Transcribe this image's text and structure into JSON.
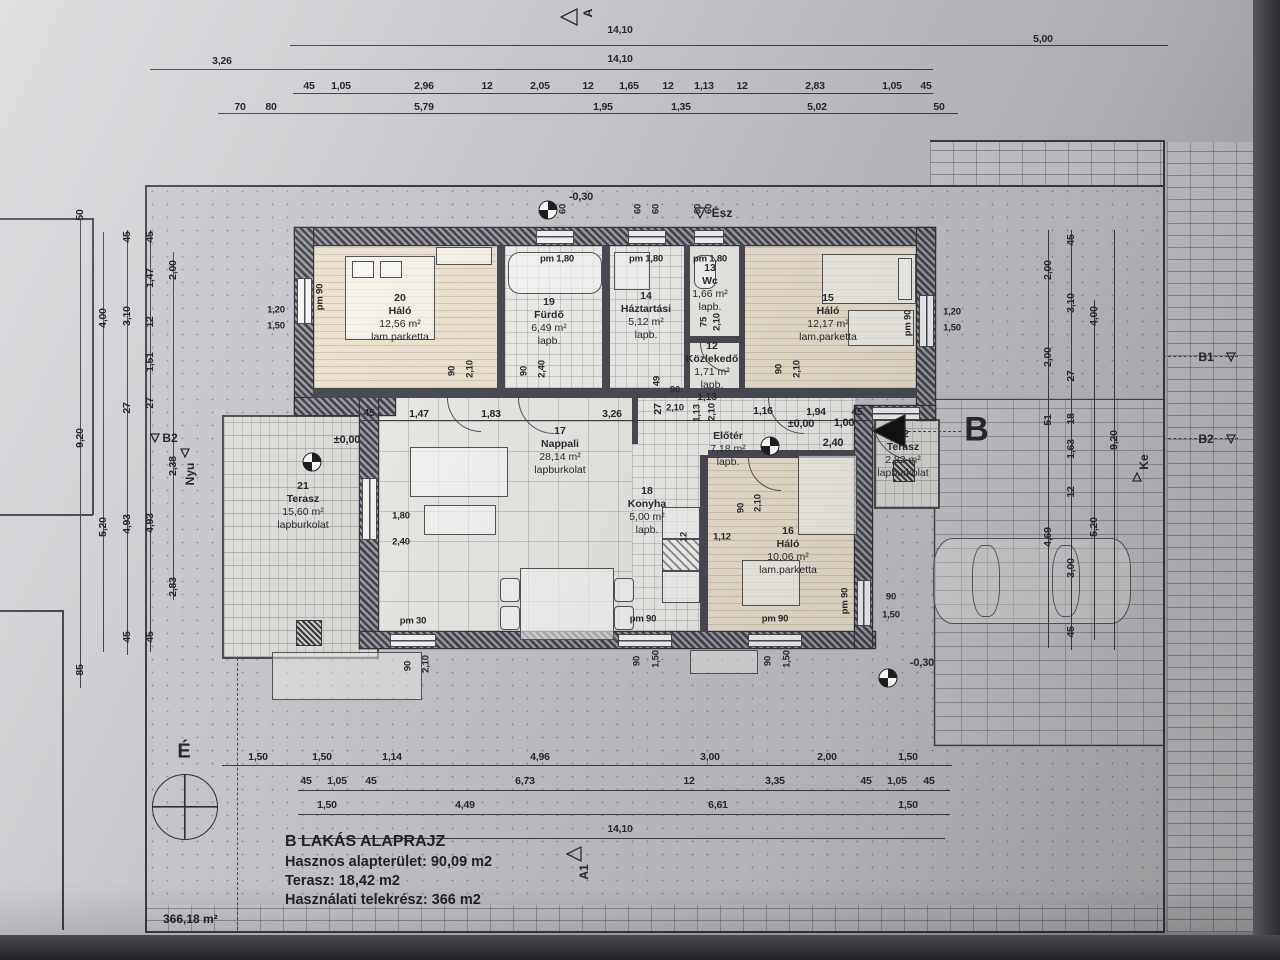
{
  "colors": {
    "paper": "#c9c9cd",
    "ink": "#26262c",
    "wall": "#45454e",
    "accent": "#111111"
  },
  "compass": {
    "label": "É"
  },
  "plot": {
    "area_label": "366,18 m²"
  },
  "title_block": {
    "title": "B LAKÁS ALAPRAJZ",
    "line2": "Hasznos alapterület: 90,09 m2",
    "line3": "Terasz:  18,42 m2",
    "line4": "Használati telekrész: 366 m2"
  },
  "rooms": [
    {
      "num": "20",
      "name": "Háló",
      "area": "12,56 m²",
      "floor": "lam.parketta",
      "x": 400,
      "y": 292,
      "w": 120
    },
    {
      "num": "19",
      "name": "Fürdő",
      "area": "6,49 m²",
      "floor": "lapb.",
      "x": 549,
      "y": 296,
      "w": 70
    },
    {
      "num": "14",
      "name": "Háztartási",
      "area": "5,12 m²",
      "floor": "lapb.",
      "x": 646,
      "y": 290,
      "w": 80
    },
    {
      "num": "13",
      "name": "Wc",
      "area": "1,66 m²",
      "floor": "lapb.",
      "x": 710,
      "y": 262,
      "w": 50
    },
    {
      "num": "15",
      "name": "Háló",
      "area": "12,17 m²",
      "floor": "lam.parketta",
      "x": 828,
      "y": 292,
      "w": 120
    },
    {
      "num": "12",
      "name": "Közlekedő",
      "area": "1,71 m²",
      "floor": "lapb.",
      "x": 712,
      "y": 340,
      "w": 90
    },
    {
      "num": "17",
      "name": "Nappali",
      "area": "28,14 m²",
      "floor": "lapburkolat",
      "x": 560,
      "y": 425,
      "w": 120
    },
    {
      "num": "18",
      "name": "Konyha",
      "area": "5,00 m²",
      "floor": "lapb.",
      "x": 647,
      "y": 485,
      "w": 70
    },
    {
      "num": "",
      "name": "Előtér",
      "area": "7,18 m²",
      "floor": "lapb.",
      "x": 728,
      "y": 430,
      "w": 80
    },
    {
      "num": "16",
      "name": "Háló",
      "area": "10,06 m²",
      "floor": "lam.parketta",
      "x": 788,
      "y": 525,
      "w": 110
    },
    {
      "num": "21",
      "name": "Terasz",
      "area": "15,60 m²",
      "floor": "lapburkolat",
      "x": 303,
      "y": 480,
      "w": 110
    },
    {
      "num": "22",
      "name": "Terasz",
      "area": "2,82 m²",
      "floor": "lapburkolat",
      "x": 903,
      "y": 428,
      "w": 90
    }
  ],
  "dims": [
    {
      "t": "14,10",
      "x": 620,
      "y": 30
    },
    {
      "t": "5,00",
      "x": 1043,
      "y": 39
    },
    {
      "t": "3,26",
      "x": 222,
      "y": 61
    },
    {
      "t": "14,10",
      "x": 620,
      "y": 59
    },
    {
      "t": "45",
      "x": 309,
      "y": 86
    },
    {
      "t": "1,05",
      "x": 341,
      "y": 86
    },
    {
      "t": "2,96",
      "x": 424,
      "y": 86
    },
    {
      "t": "12",
      "x": 487,
      "y": 86
    },
    {
      "t": "2,05",
      "x": 540,
      "y": 86
    },
    {
      "t": "12",
      "x": 588,
      "y": 86
    },
    {
      "t": "1,65",
      "x": 629,
      "y": 86
    },
    {
      "t": "12",
      "x": 668,
      "y": 86
    },
    {
      "t": "1,13",
      "x": 704,
      "y": 86
    },
    {
      "t": "12",
      "x": 742,
      "y": 86
    },
    {
      "t": "2,83",
      "x": 815,
      "y": 86
    },
    {
      "t": "1,05",
      "x": 892,
      "y": 86
    },
    {
      "t": "45",
      "x": 926,
      "y": 86
    },
    {
      "t": "70",
      "x": 240,
      "y": 107
    },
    {
      "t": "80",
      "x": 271,
      "y": 107
    },
    {
      "t": "5,79",
      "x": 424,
      "y": 107
    },
    {
      "t": "1,95",
      "x": 603,
      "y": 107
    },
    {
      "t": "1,35",
      "x": 681,
      "y": 107
    },
    {
      "t": "5,02",
      "x": 817,
      "y": 107
    },
    {
      "t": "50",
      "x": 939,
      "y": 107
    },
    {
      "t": "45",
      "x": 369,
      "y": 413
    },
    {
      "t": "1,47",
      "x": 419,
      "y": 414
    },
    {
      "t": "1,83",
      "x": 491,
      "y": 414
    },
    {
      "t": "3,26",
      "x": 612,
      "y": 414
    },
    {
      "t": "27",
      "x": 658,
      "y": 409,
      "r": 1
    },
    {
      "t": "1,13",
      "x": 707,
      "y": 397
    },
    {
      "t": "1,16",
      "x": 763,
      "y": 411
    },
    {
      "t": "1,94",
      "x": 816,
      "y": 412
    },
    {
      "t": "45",
      "x": 857,
      "y": 412
    },
    {
      "t": "1,50",
      "x": 258,
      "y": 757
    },
    {
      "t": "1,50",
      "x": 322,
      "y": 757
    },
    {
      "t": "1,14",
      "x": 392,
      "y": 757
    },
    {
      "t": "4,96",
      "x": 540,
      "y": 757
    },
    {
      "t": "3,00",
      "x": 710,
      "y": 757
    },
    {
      "t": "2,00",
      "x": 827,
      "y": 757
    },
    {
      "t": "1,50",
      "x": 908,
      "y": 757
    },
    {
      "t": "45",
      "x": 306,
      "y": 781
    },
    {
      "t": "1,05",
      "x": 337,
      "y": 781
    },
    {
      "t": "45",
      "x": 371,
      "y": 781
    },
    {
      "t": "6,73",
      "x": 525,
      "y": 781
    },
    {
      "t": "12",
      "x": 689,
      "y": 781
    },
    {
      "t": "3,35",
      "x": 775,
      "y": 781
    },
    {
      "t": "45",
      "x": 866,
      "y": 781
    },
    {
      "t": "1,05",
      "x": 897,
      "y": 781
    },
    {
      "t": "45",
      "x": 929,
      "y": 781
    },
    {
      "t": "1,50",
      "x": 327,
      "y": 805
    },
    {
      "t": "4,49",
      "x": 465,
      "y": 805
    },
    {
      "t": "6,61",
      "x": 718,
      "y": 805
    },
    {
      "t": "1,50",
      "x": 908,
      "y": 805
    },
    {
      "t": "14,10",
      "x": 620,
      "y": 829
    },
    {
      "t": "50",
      "x": 80,
      "y": 215,
      "r": 1
    },
    {
      "t": "9,20",
      "x": 80,
      "y": 438,
      "r": 1
    },
    {
      "t": "85",
      "x": 80,
      "y": 670,
      "r": 1
    },
    {
      "t": "4,00",
      "x": 103,
      "y": 318,
      "r": 1
    },
    {
      "t": "5,20",
      "x": 103,
      "y": 527,
      "r": 1
    },
    {
      "t": "45",
      "x": 127,
      "y": 237,
      "r": 1
    },
    {
      "t": "3,10",
      "x": 127,
      "y": 316,
      "r": 1
    },
    {
      "t": "27",
      "x": 127,
      "y": 408,
      "r": 1
    },
    {
      "t": "4,93",
      "x": 127,
      "y": 524,
      "r": 1
    },
    {
      "t": "45",
      "x": 127,
      "y": 637,
      "r": 1
    },
    {
      "t": "45",
      "x": 150,
      "y": 237,
      "r": 1
    },
    {
      "t": "1,47",
      "x": 150,
      "y": 278,
      "r": 1
    },
    {
      "t": "12",
      "x": 150,
      "y": 322,
      "r": 1
    },
    {
      "t": "1,51",
      "x": 150,
      "y": 362,
      "r": 1
    },
    {
      "t": "27",
      "x": 150,
      "y": 403,
      "r": 1
    },
    {
      "t": "4,93",
      "x": 150,
      "y": 523,
      "r": 1
    },
    {
      "t": "45",
      "x": 150,
      "y": 637,
      "r": 1
    },
    {
      "t": "2,00",
      "x": 173,
      "y": 270,
      "r": 1
    },
    {
      "t": "2,38",
      "x": 173,
      "y": 466,
      "r": 1
    },
    {
      "t": "2,83",
      "x": 173,
      "y": 587,
      "r": 1
    },
    {
      "t": "2,00",
      "x": 1048,
      "y": 270,
      "r": 1
    },
    {
      "t": "2,00",
      "x": 1048,
      "y": 357,
      "r": 1
    },
    {
      "t": "51",
      "x": 1048,
      "y": 420,
      "r": 1
    },
    {
      "t": "4,69",
      "x": 1048,
      "y": 537,
      "r": 1
    },
    {
      "t": "45",
      "x": 1071,
      "y": 240,
      "r": 1
    },
    {
      "t": "3,10",
      "x": 1071,
      "y": 303,
      "r": 1
    },
    {
      "t": "27",
      "x": 1071,
      "y": 376,
      "r": 1
    },
    {
      "t": "18",
      "x": 1071,
      "y": 419,
      "r": 1
    },
    {
      "t": "1,63",
      "x": 1071,
      "y": 449,
      "r": 1
    },
    {
      "t": "12",
      "x": 1071,
      "y": 492,
      "r": 1
    },
    {
      "t": "3,00",
      "x": 1071,
      "y": 568,
      "r": 1
    },
    {
      "t": "45",
      "x": 1071,
      "y": 632,
      "r": 1
    },
    {
      "t": "4,00",
      "x": 1094,
      "y": 316,
      "r": 1
    },
    {
      "t": "5,20",
      "x": 1094,
      "y": 527,
      "r": 1
    },
    {
      "t": "9,20",
      "x": 1114,
      "y": 440,
      "r": 1
    }
  ],
  "fixtures": [
    {
      "t": "pm 1,80",
      "x": 557,
      "y": 259
    },
    {
      "t": "pm 1,80",
      "x": 646,
      "y": 259
    },
    {
      "t": "pm 1,80",
      "x": 710,
      "y": 259
    },
    {
      "t": "pm 90",
      "x": 320,
      "y": 297,
      "r": 1
    },
    {
      "t": "pm 90",
      "x": 908,
      "y": 323,
      "r": 1
    },
    {
      "t": "pm 90",
      "x": 845,
      "y": 601,
      "r": 1
    },
    {
      "t": "1,20",
      "x": 276,
      "y": 310
    },
    {
      "t": "1,50",
      "x": 276,
      "y": 326
    },
    {
      "t": "1,20",
      "x": 952,
      "y": 312
    },
    {
      "t": "1,50",
      "x": 952,
      "y": 328
    },
    {
      "t": "90",
      "x": 891,
      "y": 597
    },
    {
      "t": "1,50",
      "x": 891,
      "y": 615
    },
    {
      "t": "pm 30",
      "x": 413,
      "y": 621
    },
    {
      "t": "pm 90",
      "x": 643,
      "y": 619
    },
    {
      "t": "pm 90",
      "x": 775,
      "y": 619
    },
    {
      "t": "90",
      "x": 637,
      "y": 661,
      "r": 1
    },
    {
      "t": "1,50",
      "x": 656,
      "y": 659,
      "r": 1
    },
    {
      "t": "90",
      "x": 768,
      "y": 661,
      "r": 1
    },
    {
      "t": "1,50",
      "x": 787,
      "y": 659,
      "r": 1
    },
    {
      "t": "90",
      "x": 408,
      "y": 666,
      "r": 1
    },
    {
      "t": "2,10",
      "x": 426,
      "y": 664,
      "r": 1
    },
    {
      "t": "90",
      "x": 452,
      "y": 371,
      "r": 1
    },
    {
      "t": "2,10",
      "x": 470,
      "y": 369,
      "r": 1
    },
    {
      "t": "90",
      "x": 524,
      "y": 371,
      "r": 1
    },
    {
      "t": "2,40",
      "x": 542,
      "y": 369,
      "r": 1
    },
    {
      "t": "90",
      "x": 779,
      "y": 369,
      "r": 1
    },
    {
      "t": "2,10",
      "x": 797,
      "y": 369,
      "r": 1
    },
    {
      "t": "90",
      "x": 741,
      "y": 508,
      "r": 1
    },
    {
      "t": "2,10",
      "x": 758,
      "y": 503,
      "r": 1
    },
    {
      "t": "75",
      "x": 704,
      "y": 322,
      "r": 1
    },
    {
      "t": "2,10",
      "x": 717,
      "y": 322,
      "r": 1
    },
    {
      "t": "1,13",
      "x": 697,
      "y": 413,
      "r": 1
    },
    {
      "t": "2,10",
      "x": 712,
      "y": 412,
      "r": 1
    },
    {
      "t": "49",
      "x": 657,
      "y": 381,
      "r": 1
    },
    {
      "t": "12",
      "x": 684,
      "y": 537,
      "r": 1
    },
    {
      "t": "60",
      "x": 563,
      "y": 209,
      "r": 1
    },
    {
      "t": "60",
      "x": 638,
      "y": 209,
      "r": 1
    },
    {
      "t": "60",
      "x": 656,
      "y": 209,
      "r": 1
    },
    {
      "t": "60",
      "x": 698,
      "y": 209,
      "r": 1
    },
    {
      "t": "60",
      "x": 709,
      "y": 209,
      "r": 1
    },
    {
      "t": "1,80",
      "x": 401,
      "y": 516
    },
    {
      "t": "2,40",
      "x": 401,
      "y": 542
    },
    {
      "t": "1,12",
      "x": 722,
      "y": 537
    },
    {
      "t": "90",
      "x": 675,
      "y": 390
    },
    {
      "t": "2,10",
      "x": 675,
      "y": 408
    }
  ],
  "levels": [
    {
      "t": "-0,30",
      "x": 581,
      "y": 197
    },
    {
      "t": "-0,30",
      "x": 922,
      "y": 663
    },
    {
      "t": "±0,00",
      "x": 347,
      "y": 440
    },
    {
      "t": "±0,00",
      "x": 801,
      "y": 424
    },
    {
      "t": "1,00",
      "x": 844,
      "y": 423
    },
    {
      "t": "2,40",
      "x": 833,
      "y": 443
    }
  ],
  "markers": [
    {
      "t": "A",
      "x": 588,
      "y": 13,
      "r": 1
    },
    {
      "t": "Ész",
      "x": 722,
      "y": 213
    },
    {
      "t": "A1",
      "x": 584,
      "y": 872,
      "r": 1
    },
    {
      "t": "B1",
      "x": 1206,
      "y": 357
    },
    {
      "t": "B2",
      "x": 1206,
      "y": 439
    },
    {
      "t": "B2",
      "x": 170,
      "y": 438
    },
    {
      "t": "Nyu",
      "x": 190,
      "y": 474,
      "r": 1
    },
    {
      "t": "Ke",
      "x": 1144,
      "y": 462,
      "r": 1
    },
    {
      "t": "B",
      "x": 977,
      "y": 430,
      "big": true
    }
  ]
}
